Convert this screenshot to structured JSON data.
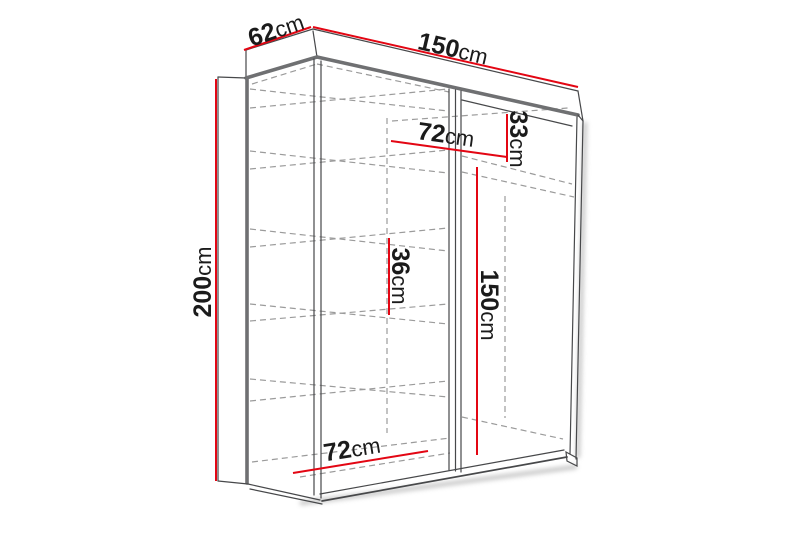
{
  "diagram": {
    "background": "#ffffff",
    "accent_red": "#e30613",
    "line_dark": "#47484a",
    "line_grey": "#6f7072",
    "dash_grey": "#9b9b9b",
    "dimensions": {
      "depth_top": {
        "value": "62",
        "unit": "cm"
      },
      "width_top": {
        "value": "150",
        "unit": "cm"
      },
      "height_left": {
        "value": "200",
        "unit": "cm"
      },
      "shelf_width_top": {
        "value": "72",
        "unit": "cm"
      },
      "top_right_section_height": {
        "value": "33",
        "unit": "cm"
      },
      "shelf_gap_middle": {
        "value": "36",
        "unit": "cm"
      },
      "hanging_space_height": {
        "value": "150",
        "unit": "cm"
      },
      "bottom_shelf_width": {
        "value": "72",
        "unit": "cm"
      }
    }
  }
}
